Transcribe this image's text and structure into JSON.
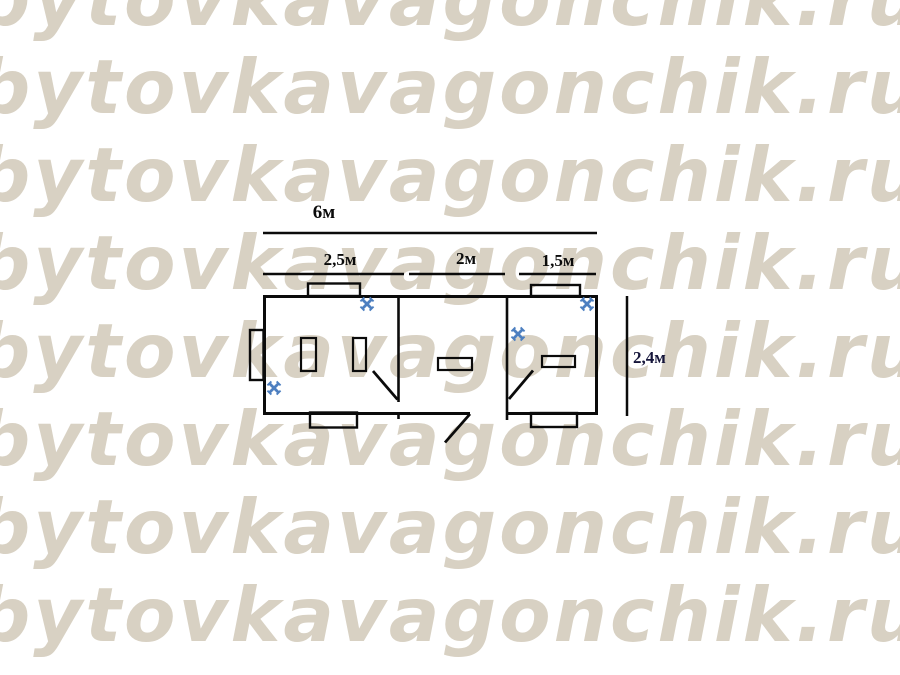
{
  "watermark": {
    "text": "bytovkavagonchik.ru",
    "color": "#d8d1c3",
    "row_count": 8
  },
  "colors": {
    "line": "#0b0b0b",
    "marker_blue": "#4d7fc0",
    "height_label": "#15153a",
    "background": "#ffffff"
  },
  "plan": {
    "type": "floor-plan",
    "dim_total": "6м",
    "dim_sections": [
      "2,5м",
      "2м",
      "1,5м"
    ],
    "dim_height": "2,4м",
    "icons": {
      "x_marker": "✕"
    }
  }
}
